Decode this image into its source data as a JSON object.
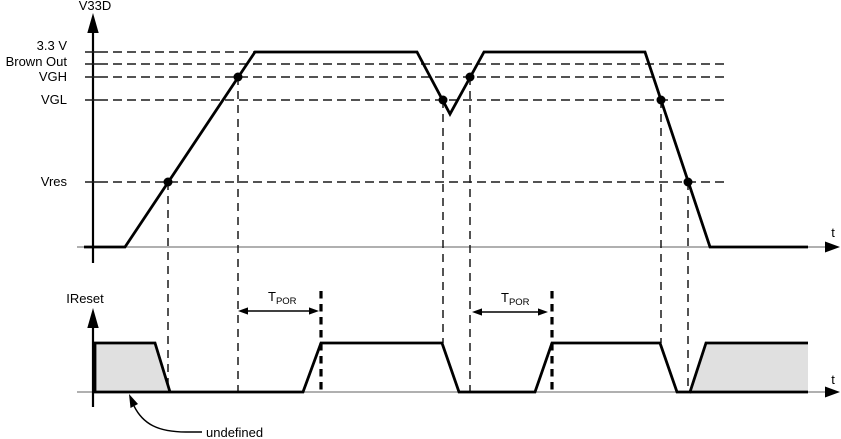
{
  "v33d_plot": {
    "axis_label": "V33D",
    "time_axis_label": "t",
    "levels": [
      {
        "label": "3.3 V"
      },
      {
        "label": "Brown Out"
      },
      {
        "label": "VGH"
      },
      {
        "label": "VGL"
      },
      {
        "label": "Vres"
      }
    ]
  },
  "ireset_plot": {
    "axis_label": "IReset",
    "time_axis_label": "t",
    "undefined_label": "undefined",
    "tpor_annotations": [
      {
        "base": "T",
        "sub": "POR"
      },
      {
        "base": "T",
        "sub": "POR"
      }
    ]
  },
  "colors": {
    "line": "#000000",
    "axis_baseline": "#808080",
    "undefined_fill": "#e0e0e0",
    "background": "#ffffff"
  },
  "diagram_data": {
    "type": "timing-diagram",
    "signals": [
      {
        "name": "V33D",
        "thresholds": [
          "3.3 V",
          "Brown Out",
          "VGH",
          "VGL",
          "Vres"
        ],
        "shape": "ramps up from 0 V to 3.3 V, holds, brown-out dip just below VGL, recovers to 3.3 V, holds, ramps down to 0 V",
        "marked_crossings": [
          {
            "threshold": "Vres",
            "edge": "rising"
          },
          {
            "threshold": "VGH",
            "edge": "rising"
          },
          {
            "threshold": "VGL",
            "edge": "falling-brownout"
          },
          {
            "threshold": "VGH",
            "edge": "rising-recovery"
          },
          {
            "threshold": "VGL",
            "edge": "falling-powerdown"
          },
          {
            "threshold": "Vres",
            "edge": "falling-powerdown"
          }
        ]
      },
      {
        "name": "IReset",
        "shape": "undefined below Vres at power-up; low until TPOR expires after VGH crossing; high; low when V33D drops below VGL; high again TPOR after VGH recovery; low below VGL at power-down; undefined below Vres",
        "timing_parameter": "TPOR",
        "undefined_regions": 2
      }
    ]
  }
}
